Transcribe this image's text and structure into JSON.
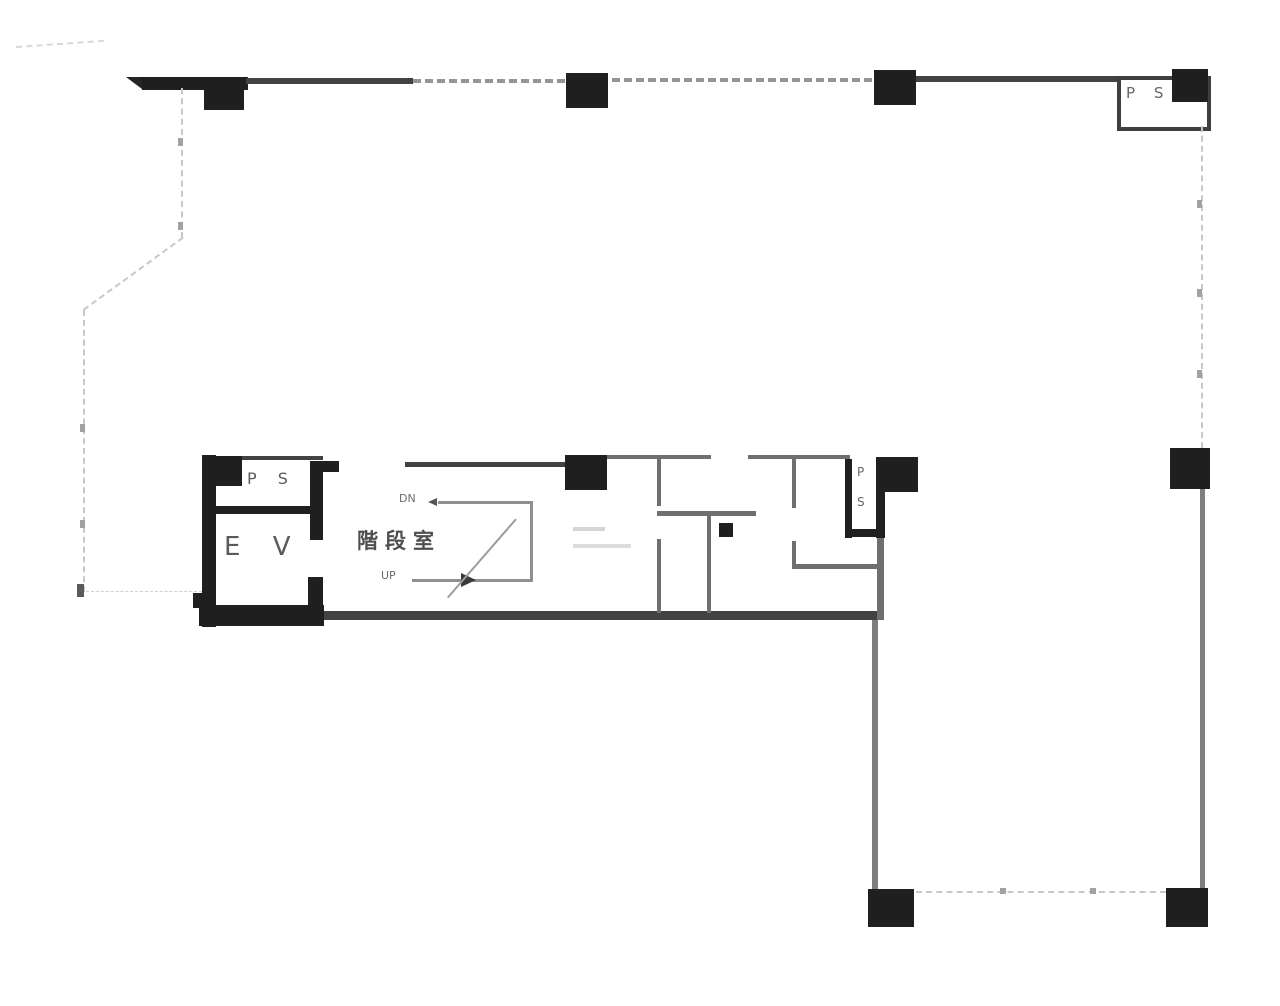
{
  "plan": {
    "type": "building-floor-plan",
    "language": "ja",
    "top_right": {
      "ps_label": "P S"
    },
    "core": {
      "ps_label": "P S",
      "ev_label": "E V",
      "stair_label": "階段室",
      "dn_label": "DN",
      "up_label": "UP"
    },
    "service": {
      "ps_p": "P",
      "ps_s": "S"
    }
  },
  "colors": {
    "background": "#ffffff",
    "wall_black": "#1f1f1f",
    "wall_dark": "#424242",
    "partition_gray": "#6f6f6f",
    "boundary_dash": "#c7c7c7",
    "label_gray": "#5a5a5a"
  }
}
